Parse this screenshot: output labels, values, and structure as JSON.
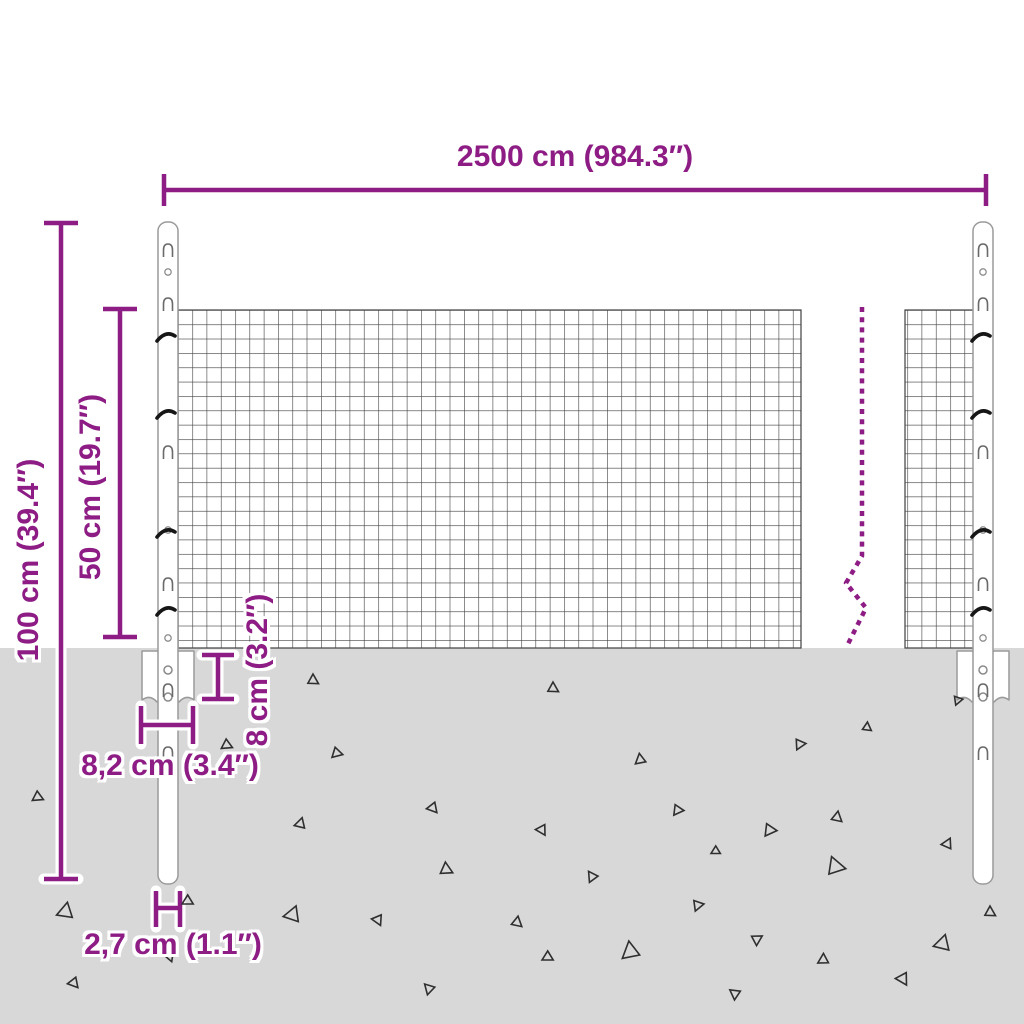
{
  "labels": {
    "width": "2500 cm (984.3″)",
    "height": "100 cm (39.4″)",
    "mesh_height": "50 cm (19.7″)",
    "anchor_height": "8 cm (3.2″)",
    "anchor_width": "8,2 cm (3.4″)",
    "post_diameter": "2,7 cm (1.1″)"
  },
  "colors": {
    "dimension_purple": "#8d1c84",
    "ground_gray": "#d8d8d8",
    "mesh_wire": "#3f3f3f",
    "post_outline": "#9a9a9a",
    "triangle_outline": "#2f2f2f"
  },
  "posts": {
    "centers": [
      168,
      983
    ],
    "slot_y": [
      250,
      304,
      452,
      584,
      690,
      753
    ],
    "hole_y": [
      272,
      530,
      638
    ],
    "clip_y": [
      337,
      414,
      533,
      611
    ]
  },
  "ground_triangles": [
    {
      "x": 38,
      "y": 797,
      "s": 6,
      "r": 115
    },
    {
      "x": 65,
      "y": 912,
      "s": 9,
      "r": 250
    },
    {
      "x": 74,
      "y": 983,
      "s": 6,
      "r": 140
    },
    {
      "x": 227,
      "y": 745,
      "s": 6,
      "r": 115
    },
    {
      "x": 188,
      "y": 901,
      "s": 6,
      "r": 120
    },
    {
      "x": 170,
      "y": 957,
      "s": 5,
      "r": 160
    },
    {
      "x": 313,
      "y": 680,
      "s": 6,
      "r": 0
    },
    {
      "x": 337,
      "y": 753,
      "s": 6,
      "r": 105
    },
    {
      "x": 300,
      "y": 824,
      "s": 6,
      "r": 255
    },
    {
      "x": 292,
      "y": 915,
      "s": 9,
      "r": 260
    },
    {
      "x": 378,
      "y": 920,
      "s": 6,
      "r": 155
    },
    {
      "x": 429,
      "y": 989,
      "s": 6,
      "r": 195
    },
    {
      "x": 433,
      "y": 808,
      "s": 6,
      "r": 140
    },
    {
      "x": 446,
      "y": 869,
      "s": 7,
      "r": 355
    },
    {
      "x": 517,
      "y": 922,
      "s": 6,
      "r": 10
    },
    {
      "x": 542,
      "y": 830,
      "s": 6,
      "r": 150
    },
    {
      "x": 548,
      "y": 957,
      "s": 6,
      "r": 120
    },
    {
      "x": 553,
      "y": 688,
      "s": 6,
      "r": 0
    },
    {
      "x": 592,
      "y": 877,
      "s": 6,
      "r": 205
    },
    {
      "x": 630,
      "y": 952,
      "s": 10,
      "r": 230
    },
    {
      "x": 640,
      "y": 760,
      "s": 6,
      "r": 230
    },
    {
      "x": 678,
      "y": 810,
      "s": 6,
      "r": 95
    },
    {
      "x": 698,
      "y": 905,
      "s": 6,
      "r": 80
    },
    {
      "x": 716,
      "y": 851,
      "s": 5,
      "r": 120
    },
    {
      "x": 735,
      "y": 994,
      "s": 6,
      "r": 185
    },
    {
      "x": 757,
      "y": 939,
      "s": 6,
      "r": 60
    },
    {
      "x": 770,
      "y": 830,
      "s": 7,
      "r": 95
    },
    {
      "x": 800,
      "y": 744,
      "s": 6,
      "r": 85
    },
    {
      "x": 823,
      "y": 960,
      "s": 6,
      "r": 240
    },
    {
      "x": 837,
      "y": 817,
      "s": 6,
      "r": 10
    },
    {
      "x": 835,
      "y": 866,
      "s": 10,
      "r": 340
    },
    {
      "x": 867,
      "y": 727,
      "s": 5,
      "r": 5
    },
    {
      "x": 903,
      "y": 979,
      "s": 7,
      "r": 150
    },
    {
      "x": 942,
      "y": 944,
      "s": 9,
      "r": 255
    },
    {
      "x": 947,
      "y": 844,
      "s": 6,
      "r": 265
    },
    {
      "x": 958,
      "y": 700,
      "s": 5,
      "r": 80
    },
    {
      "x": 990,
      "y": 912,
      "s": 6,
      "r": 0
    }
  ]
}
